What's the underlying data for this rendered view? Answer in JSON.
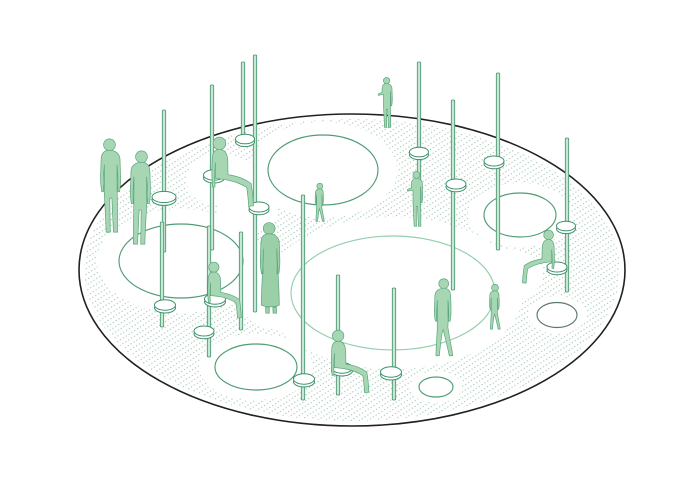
{
  "canvas": {
    "width": 691,
    "height": 496,
    "background": "#ffffff"
  },
  "colors": {
    "platform_stroke": "#212121",
    "dot": "#a2c4b2",
    "figure_fill": "#a7d7b2",
    "figure_fill_dark": "#9bcfa8",
    "figure_stroke": "#5aa57e",
    "pole_fill": "#c8e7d2",
    "pole_stroke": "#3d916b",
    "ring_stroke": "#3d916b",
    "ring_fill": "#ffffff",
    "hole_dark": "#4e9c73",
    "hole_light": "#93cfae",
    "hole_gray": "#5d7a6c",
    "halo_fill": "#ffffff"
  },
  "platform": {
    "cx": 352,
    "cy": 270,
    "rx": 273,
    "ry": 156,
    "stroke_width": 1.6
  },
  "texture": {
    "tile_w": 3.4,
    "tile_h": 4.6,
    "dot_r": 0.62,
    "angle": -33
  },
  "holes": [
    {
      "cx": 323,
      "cy": 170,
      "rx": 55,
      "ry": 35,
      "stroke": "hole_dark",
      "halo_rx": 74,
      "halo_ry": 48
    },
    {
      "cx": 181,
      "cy": 261,
      "rx": 62,
      "ry": 37,
      "stroke": "hole_dark",
      "halo_rx": 84,
      "halo_ry": 52
    },
    {
      "cx": 393,
      "cy": 293,
      "rx": 102,
      "ry": 57,
      "stroke": "hole_light",
      "halo_rx": 130,
      "halo_ry": 76
    },
    {
      "cx": 520,
      "cy": 215,
      "rx": 36,
      "ry": 22,
      "stroke": "hole_dark",
      "halo_rx": 52,
      "halo_ry": 32
    },
    {
      "cx": 256,
      "cy": 367,
      "rx": 41,
      "ry": 23,
      "stroke": "hole_dark",
      "halo_rx": 57,
      "halo_ry": 33
    },
    {
      "cx": 557,
      "cy": 315,
      "rx": 20,
      "ry": 12.5,
      "stroke": "hole_gray",
      "halo_rx": 29,
      "halo_ry": 19
    },
    {
      "cx": 436,
      "cy": 387,
      "rx": 17,
      "ry": 10,
      "stroke": "hole_dark",
      "halo_rx": 26,
      "halo_ry": 16
    }
  ],
  "white_patches": [
    {
      "cx": 282,
      "cy": 300,
      "rx": 42,
      "ry": 30
    },
    {
      "cx": 505,
      "cy": 275,
      "rx": 38,
      "ry": 26
    },
    {
      "cx": 248,
      "cy": 212,
      "rx": 30,
      "ry": 20
    },
    {
      "cx": 222,
      "cy": 180,
      "rx": 36,
      "ry": 26
    }
  ],
  "poles": [
    {
      "x": 164,
      "y1": 110,
      "y2": 252
    },
    {
      "x": 212,
      "y1": 85,
      "y2": 250
    },
    {
      "x": 243,
      "y1": 62,
      "y2": 145
    },
    {
      "x": 255,
      "y1": 55,
      "y2": 312
    },
    {
      "x": 162,
      "y1": 222,
      "y2": 327
    },
    {
      "x": 209,
      "y1": 226,
      "y2": 357
    },
    {
      "x": 241,
      "y1": 232,
      "y2": 330
    },
    {
      "x": 303,
      "y1": 195,
      "y2": 400
    },
    {
      "x": 338,
      "y1": 275,
      "y2": 395
    },
    {
      "x": 394,
      "y1": 288,
      "y2": 400
    },
    {
      "x": 419,
      "y1": 62,
      "y2": 200
    },
    {
      "x": 453,
      "y1": 100,
      "y2": 290
    },
    {
      "x": 498,
      "y1": 73,
      "y2": 250
    },
    {
      "x": 567,
      "y1": 138,
      "y2": 292
    }
  ],
  "rings": [
    {
      "cx": 164,
      "cy": 197,
      "rx": 12,
      "ry": 5.6
    },
    {
      "cx": 214,
      "cy": 175,
      "rx": 10.5,
      "ry": 5.2
    },
    {
      "cx": 245,
      "cy": 139,
      "rx": 9.5,
      "ry": 4.8
    },
    {
      "cx": 259,
      "cy": 207,
      "rx": 10,
      "ry": 5
    },
    {
      "cx": 165,
      "cy": 305,
      "rx": 10.5,
      "ry": 5.2
    },
    {
      "cx": 215,
      "cy": 299,
      "rx": 10.5,
      "ry": 5.2
    },
    {
      "cx": 204,
      "cy": 331,
      "rx": 10,
      "ry": 5
    },
    {
      "cx": 304,
      "cy": 379,
      "rx": 10.5,
      "ry": 5.2
    },
    {
      "cx": 342,
      "cy": 368,
      "rx": 10.5,
      "ry": 5.2
    },
    {
      "cx": 391,
      "cy": 372,
      "rx": 10.5,
      "ry": 5.2
    },
    {
      "cx": 419,
      "cy": 152,
      "rx": 9.5,
      "ry": 4.8
    },
    {
      "cx": 456,
      "cy": 184,
      "rx": 10,
      "ry": 5
    },
    {
      "cx": 494,
      "cy": 161,
      "rx": 10,
      "ry": 5
    },
    {
      "cx": 566,
      "cy": 226,
      "rx": 9.5,
      "ry": 4.8
    },
    {
      "cx": 557,
      "cy": 267,
      "rx": 10,
      "ry": 5
    }
  ],
  "figures": [
    {
      "pose": "stand",
      "x": 93,
      "y": 138,
      "h": 97,
      "flip": false,
      "dark": false
    },
    {
      "pose": "stand",
      "x": 125,
      "y": 150,
      "h": 97,
      "flip": true,
      "dark": false
    },
    {
      "pose": "sit",
      "x": 206,
      "y": 137,
      "h": 73,
      "flip": false,
      "dark": false
    },
    {
      "pose": "reach",
      "x": 378,
      "y": 77,
      "h": 52,
      "flip": false,
      "dark": false
    },
    {
      "pose": "reach",
      "x": 407,
      "y": 171,
      "h": 57,
      "flip": false,
      "dark": false
    },
    {
      "pose": "child",
      "x": 313,
      "y": 183,
      "h": 40,
      "flip": true,
      "dark": false
    },
    {
      "pose": "coat",
      "x": 253,
      "y": 222,
      "h": 95,
      "flip": false,
      "dark": true
    },
    {
      "pose": "sit",
      "x": 203,
      "y": 262,
      "h": 59,
      "flip": false,
      "dark": false
    },
    {
      "pose": "sit",
      "x": 326,
      "y": 330,
      "h": 66,
      "flip": false,
      "dark": false
    },
    {
      "pose": "walk",
      "x": 430,
      "y": 278,
      "h": 81,
      "flip": true,
      "dark": false
    },
    {
      "pose": "sit",
      "x": 521,
      "y": 230,
      "h": 56,
      "flip": true,
      "dark": false
    },
    {
      "pose": "child",
      "x": 487,
      "y": 284,
      "h": 47,
      "flip": true,
      "dark": false
    }
  ]
}
